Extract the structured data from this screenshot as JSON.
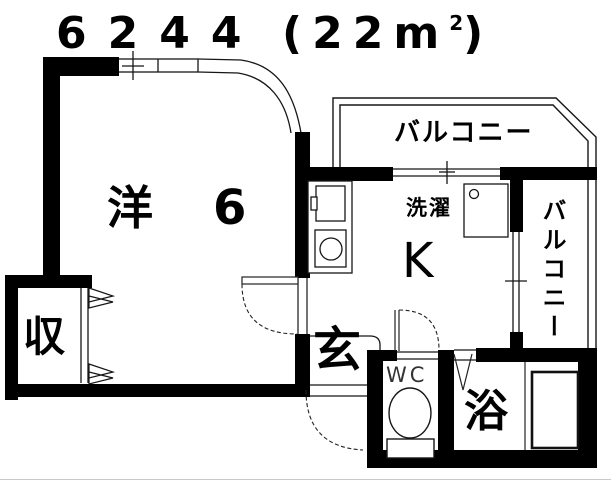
{
  "title": {
    "unit_number": "6244",
    "area_open": "(22m",
    "area_sup": "2",
    "area_close": ")"
  },
  "labels": {
    "main_room": "洋",
    "main_room_size": "6",
    "balcony_top": "バルコニー",
    "balcony_right": "バルコニー",
    "laundry": "洗濯",
    "kitchen": "K",
    "entrance": "玄",
    "toilet": "WC",
    "bath": "浴",
    "storage": "収"
  },
  "colors": {
    "wall": "#000000",
    "line": "#161616",
    "background": "#ffffff",
    "text": "#000000"
  }
}
